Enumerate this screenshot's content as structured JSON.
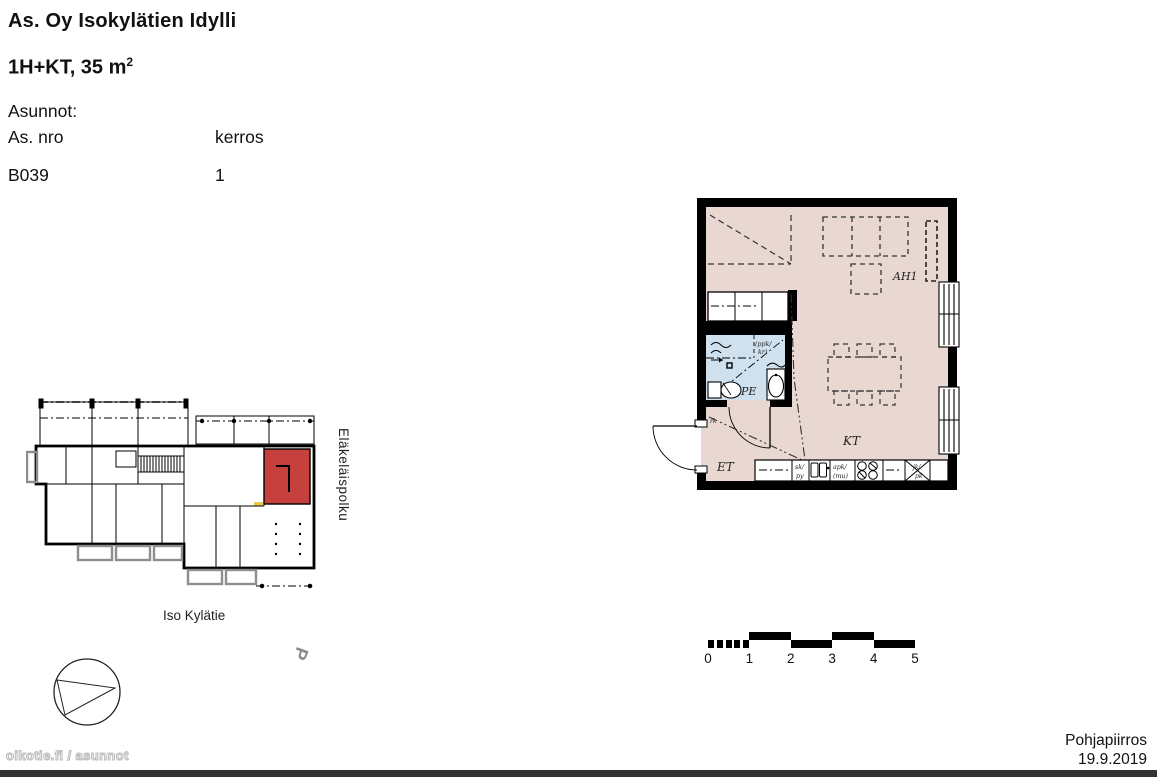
{
  "header": {
    "title": "As. Oy Isokylätien Idylli",
    "type_prefix": "1H+KT, 35 m",
    "type_sup": "2",
    "apartments_label": "Asunnot:",
    "col_no": "As. nro",
    "col_floor": "kerros",
    "unit_no": "B039",
    "unit_floor": "1"
  },
  "site": {
    "street_side": "Eläkeläispolku",
    "street_bottom": "Iso Kylätie",
    "north_letter": "P",
    "highlight_color": "#c6403d"
  },
  "plan": {
    "room_living": "AH1",
    "room_kitchen": "KT",
    "room_entry": "ET",
    "room_bath": "PE",
    "lbl_ppk1": "(ppk/",
    "lbl_ppk2": "kr)",
    "lbl_sk1": "sk/",
    "lbl_sk2": "py",
    "lbl_apk1": "apk/",
    "lbl_apk2": "(mu)",
    "lbl_jk1": "jk/",
    "lbl_jk2": "pk",
    "lbl_rk": "rk",
    "floor_color": "#e9d8d2",
    "bath_color": "#cfe0ee"
  },
  "scale": {
    "ticks": [
      "0",
      "1",
      "2",
      "3",
      "4",
      "5"
    ]
  },
  "footer": {
    "doc": "Pohjapiirros",
    "date": "19.9.2019",
    "watermark": "oikotie.fi / asunnot"
  }
}
